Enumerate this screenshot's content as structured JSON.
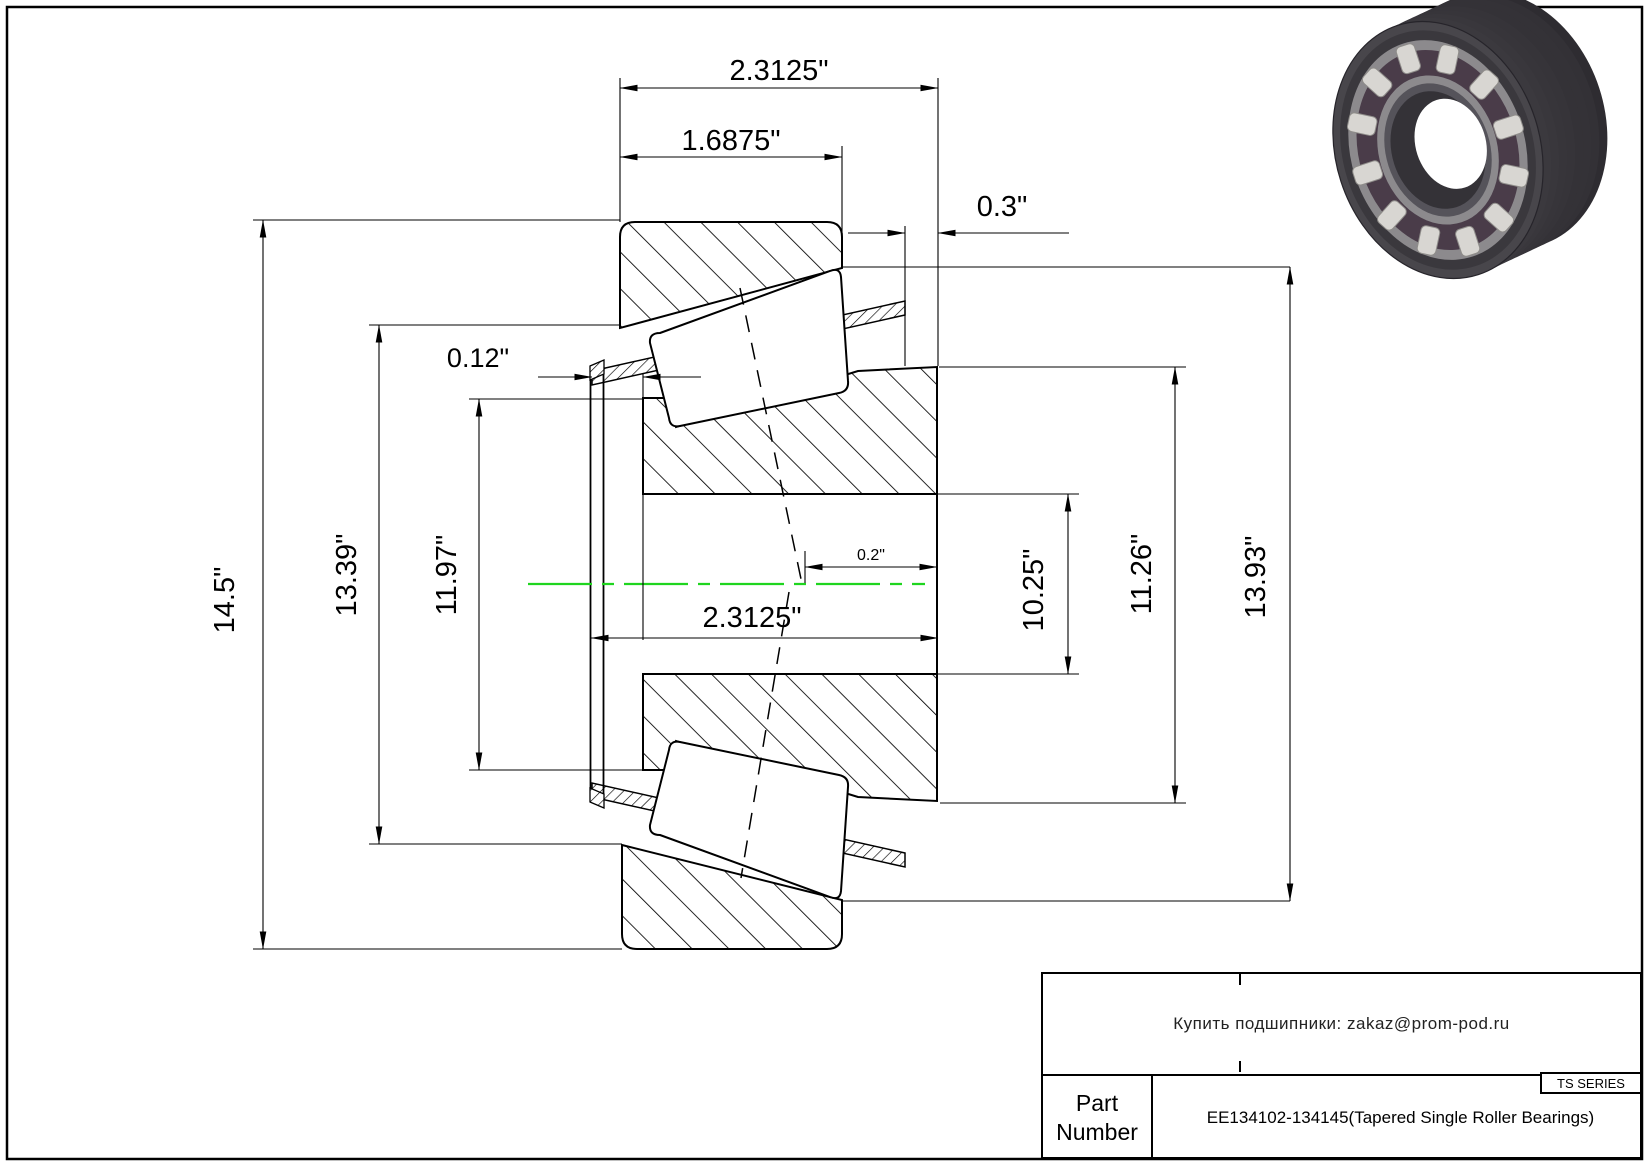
{
  "colors": {
    "centerline_green": "#1fd51f",
    "drawing_line": "#000000",
    "bearing_dark": "#3d3b40",
    "bearing_race_gray": "#8c8a8d",
    "bearing_roller_light": "#d8d6d2",
    "bearing_cage_purple": "#4a3c49"
  },
  "drawing": {
    "dim_labels": {
      "top_overall": "2.3125\"",
      "cup_front_width": "1.6875\"",
      "cup_stand_out": "0.3\"",
      "cage_flange": "0.12\"",
      "left_od": "14.5\"",
      "left_race_od": "13.39\"",
      "left_rib_od": "11.97\"",
      "bore_width": "2.3125\"",
      "apex_offset": "0.2\"",
      "bore_dia": "10.25\"",
      "right_rib_od": "11.26\"",
      "right_race_od": "13.93\""
    }
  },
  "illustration": {
    "name": "tapered-roller-bearing-3d-view"
  },
  "title_block": {
    "contact": "Купить подшипники: zakaz@prom-pod.ru",
    "series_badge": "TS SERIES",
    "part_label": "Part Number",
    "part_number": "EE134102-134145(Tapered Single Roller Bearings)"
  }
}
